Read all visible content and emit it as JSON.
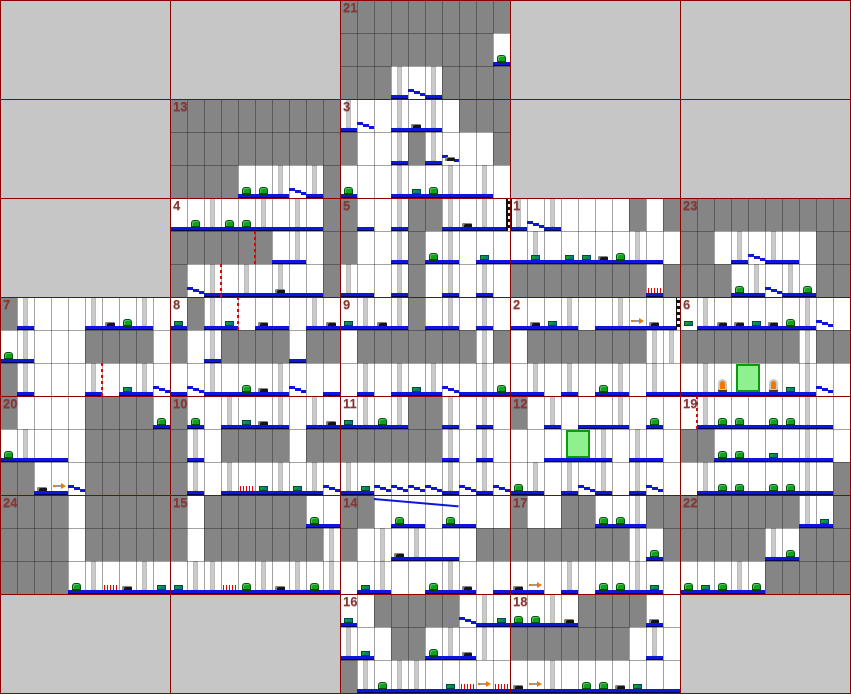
{
  "map": {
    "cols": 5,
    "rows": 7,
    "room_w": 170,
    "room_h": 99,
    "tile": {
      "w": 17,
      "h": 33
    },
    "colors": {
      "unused_cell": "#c6c6c6",
      "room_bg": "#ffffff",
      "block": "#858585",
      "grid_line": "#8b0000",
      "tile_line": "#6f6f6f",
      "pillar": "#cacaca",
      "floor_blue": "#0e16dc",
      "bug_green": "#0da51c",
      "teal_item": "#0a7d7d",
      "black_item": "#151515",
      "spike_red": "#e80000",
      "rope_red": "#e80000",
      "door_fill": "#8ef08e",
      "door_border": "#0a9a0a",
      "figure_orange": "#f07800",
      "arrow_orange": "#f07800",
      "number_text": "#8b3434"
    },
    "legend": {
      "#": "solid-block",
      ".": "empty",
      "_": "floor",
      "l": "pillar",
      "L": "pillar-with-floor",
      "/": "stepped-slope-floor"
    },
    "item_legend": {
      "g": "green-bug",
      "t": "teal-chest",
      "b": "black-debris",
      "k": "red-spikes",
      "a": "right-arrow",
      "r": "red-dashed-rope",
      "S": "striped-pole",
      "d": "green-door",
      "f": "orange-idol",
      "W": "long-ramp"
    },
    "empty_cells": [
      [
        0,
        0
      ],
      [
        1,
        0
      ],
      [
        3,
        0
      ],
      [
        4,
        0
      ],
      [
        0,
        1
      ],
      [
        3,
        1
      ],
      [
        4,
        1
      ],
      [
        0,
        2
      ],
      [
        0,
        6
      ],
      [
        1,
        6
      ],
      [
        4,
        6
      ]
    ],
    "rooms": [
      {
        "n": "21",
        "c": 2,
        "r": 0,
        "t": [
          "##########",
          "#########_",
          "###L/L####"
        ],
        "i": [
          [
            "g",
            9,
            1
          ]
        ]
      },
      {
        "n": "13",
        "c": 1,
        "r": 1,
        "t": [
          "##########",
          "##########",
          "####__L/L#"
        ],
        "i": [
          [
            "g",
            4,
            2
          ],
          [
            "g",
            5,
            2
          ]
        ]
      },
      {
        "n": "3",
        "c": 2,
        "r": 1,
        "t": [
          "L/.L_L.###",
          "#..L#L/..#",
          "_..L__L_L."
        ],
        "i": [
          [
            "b",
            4,
            0
          ],
          [
            "b",
            6,
            1
          ],
          [
            "g",
            0,
            2
          ],
          [
            "t",
            4,
            2
          ],
          [
            "g",
            5,
            2
          ]
        ]
      },
      {
        "n": "4",
        "c": 1,
        "r": 2,
        "t": [
          "__L__L_L_#",
          "######_L.#",
          "#/L_L_L__#"
        ],
        "i": [
          [
            "g",
            1,
            0
          ],
          [
            "g",
            3,
            0
          ],
          [
            "g",
            4,
            0
          ],
          [
            "r",
            5,
            1
          ],
          [
            "r",
            3,
            2
          ],
          [
            "b",
            6,
            2
          ]
        ]
      },
      {
        "n": "5",
        "c": 2,
        "r": 2,
        "t": [
          "#_.L##L_L_",
          "#..L#_L.__",
          "L_.L#.L.L."
        ],
        "i": [
          [
            "S",
            9,
            0,
            13
          ],
          [
            "b",
            7,
            0
          ],
          [
            "g",
            5,
            1
          ],
          [
            "t",
            8,
            1
          ]
        ]
      },
      {
        "n": "1",
        "c": 3,
        "r": 2,
        "t": [
          "L/L....#.#",
          "_L_____L_.",
          "########_#"
        ],
        "i": [
          [
            "S",
            0,
            0,
            -3
          ],
          [
            "t",
            1,
            1
          ],
          [
            "t",
            3,
            1
          ],
          [
            "t",
            4,
            1
          ],
          [
            "b",
            5,
            1
          ],
          [
            "g",
            6,
            1
          ],
          [
            "k",
            8,
            2
          ]
        ]
      },
      {
        "n": "23",
        "c": 4,
        "r": 2,
        "t": [
          "##########",
          "##.L/L_.##",
          "###_L/L_##"
        ],
        "i": [
          [
            "g",
            3,
            2
          ],
          [
            "g",
            7,
            2
          ]
        ]
      },
      {
        "n": "7",
        "c": 0,
        "r": 3,
        "t": [
          "#L...L__L.",
          "_L...####.",
          "#L...L._L/"
        ],
        "i": [
          [
            "b",
            6,
            0
          ],
          [
            "g",
            7,
            0
          ],
          [
            "g",
            0,
            1
          ],
          [
            "r",
            6,
            2
          ],
          [
            "t",
            7,
            2
          ]
        ]
      },
      {
        "n": "8",
        "c": 1,
        "r": 3,
        "t": [
          "_#L_.__.L_",
          "#.L####_##",
          "_/L___L/._"
        ],
        "i": [
          [
            "t",
            0,
            0
          ],
          [
            "t",
            3,
            0
          ],
          [
            "r",
            4,
            0
          ],
          [
            "b",
            5,
            0
          ],
          [
            "b",
            9,
            0
          ],
          [
            "g",
            4,
            2
          ],
          [
            "b",
            5,
            2
          ]
        ]
      },
      {
        "n": "9",
        "c": 2,
        "r": 3,
        "t": [
          "_L_L#_L.L.",
          ".#######l#",
          ".L.L_L/_L_"
        ],
        "i": [
          [
            "t",
            0,
            0
          ],
          [
            "b",
            2,
            0
          ],
          [
            "t",
            4,
            2
          ],
          [
            "g",
            9,
            2
          ]
        ]
      },
      {
        "n": "2",
        "c": 3,
        "r": 3,
        "t": [
          "___L._L___",
          ".#######ll",
          "_L.L._L.L_"
        ],
        "i": [
          [
            "b",
            1,
            0
          ],
          [
            "t",
            2,
            0
          ],
          [
            "a",
            7,
            0
          ],
          [
            "b",
            8,
            0
          ],
          [
            "S",
            9,
            0,
            13
          ],
          [
            "g",
            5,
            2
          ]
        ]
      },
      {
        "n": "6",
        "c": 4,
        "r": 3,
        "t": [
          ".L_____L/.",
          "#######l##",
          "_L_____L/."
        ],
        "i": [
          [
            "t",
            0,
            0
          ],
          [
            "b",
            2,
            0
          ],
          [
            "b",
            3,
            0
          ],
          [
            "t",
            4,
            0
          ],
          [
            "b",
            5,
            0
          ],
          [
            "g",
            6,
            0
          ],
          [
            "f",
            2,
            2
          ],
          [
            "d",
            3,
            2
          ],
          [
            "f",
            5,
            2
          ],
          [
            "t",
            6,
            2
          ]
        ]
      },
      {
        "n": "20",
        "c": 0,
        "r": 4,
        "t": [
          "#....####_",
          "_L__.#####",
          "##__/#####"
        ],
        "i": [
          [
            "g",
            9,
            0
          ],
          [
            "g",
            0,
            1
          ],
          [
            "b",
            2,
            2
          ],
          [
            "a",
            3,
            2
          ]
        ]
      },
      {
        "n": "10",
        "c": 1,
        "r": 4,
        "t": [
          "#_.L__L.L_",
          "#L.####.##",
          "#L.L__L_L/"
        ],
        "i": [
          [
            "g",
            1,
            0
          ],
          [
            "t",
            4,
            0
          ],
          [
            "b",
            5,
            0
          ],
          [
            "b",
            9,
            0
          ],
          [
            "k",
            4,
            2
          ],
          [
            "t",
            5,
            2
          ],
          [
            "t",
            7,
            2
          ]
        ]
      },
      {
        "n": "11",
        "c": 2,
        "r": 4,
        "t": [
          "_L_L##L.L.",
          "######L.L.",
          "L_////L/L/"
        ],
        "i": [
          [
            "t",
            0,
            0
          ],
          [
            "g",
            2,
            0
          ],
          [
            "t",
            1,
            2
          ]
        ]
      },
      {
        "n": "12",
        "c": 3,
        "r": 4,
        "t": [
          "#.L.__L._.",
          "..___L.L_.",
          "_L.L/L.L/."
        ],
        "i": [
          [
            "g",
            8,
            0
          ],
          [
            "d",
            3,
            1
          ],
          [
            "g",
            0,
            2
          ]
        ]
      },
      {
        "n": "19",
        "c": 4,
        "r": 4,
        "t": [
          ".L_____L_.",
          "##_____L_.",
          ".L_____L_#"
        ],
        "i": [
          [
            "r",
            1,
            0
          ],
          [
            "g",
            2,
            0
          ],
          [
            "g",
            3,
            0
          ],
          [
            "g",
            5,
            0
          ],
          [
            "g",
            6,
            0
          ],
          [
            "g",
            2,
            1
          ],
          [
            "g",
            3,
            1
          ],
          [
            "t",
            5,
            1
          ],
          [
            "g",
            2,
            2
          ],
          [
            "g",
            3,
            2
          ],
          [
            "g",
            5,
            2
          ],
          [
            "g",
            6,
            2
          ]
        ]
      },
      {
        "n": "24",
        "c": 0,
        "r": 5,
        "t": [
          "####.#####",
          "####.#####",
          "####_L__L_"
        ],
        "i": [
          [
            "g",
            4,
            2
          ],
          [
            "k",
            6,
            2
          ],
          [
            "b",
            7,
            2
          ],
          [
            "t",
            9,
            2
          ]
        ]
      },
      {
        "n": "15",
        "c": 1,
        "r": 5,
        "t": [
          "#.######__",
          "#.#######l",
          "_LL__L_L_L"
        ],
        "i": [
          [
            "g",
            8,
            0
          ],
          [
            "t",
            0,
            2
          ],
          [
            "k",
            3,
            2
          ],
          [
            "g",
            4,
            2
          ],
          [
            "b",
            6,
            2
          ],
          [
            "g",
            8,
            2
          ]
        ]
      },
      {
        "n": "14",
        "c": 2,
        "r": 5,
        "t": [
          "##.__.__..",
          "#.l_L__.##",
          "._L.._L_._"
        ],
        "i": [
          [
            "W",
            2,
            0,
            5
          ],
          [
            "g",
            3,
            0
          ],
          [
            "g",
            6,
            0
          ],
          [
            "b",
            3,
            1
          ],
          [
            "t",
            1,
            2
          ],
          [
            "g",
            5,
            2
          ],
          [
            "b",
            7,
            2
          ]
        ]
      },
      {
        "n": "17",
        "c": 3,
        "r": 5,
        "t": [
          "#..##__L##",
          "#######l_#",
          "__.L.__L_."
        ],
        "i": [
          [
            "g",
            5,
            0
          ],
          [
            "g",
            6,
            0
          ],
          [
            "g",
            8,
            1
          ],
          [
            "b",
            0,
            2
          ],
          [
            "a",
            1,
            2
          ],
          [
            "g",
            5,
            2
          ],
          [
            "g",
            6,
            2
          ],
          [
            "t",
            8,
            2
          ]
        ]
      },
      {
        "n": "22",
        "c": 4,
        "r": 5,
        "t": [
          "#######L_#",
          "#####L_###",
          "___L_#####"
        ],
        "i": [
          [
            "t",
            8,
            0
          ],
          [
            "g",
            6,
            1
          ],
          [
            "g",
            0,
            2
          ],
          [
            "t",
            1,
            2
          ],
          [
            "g",
            2,
            2
          ],
          [
            "g",
            4,
            2
          ]
        ]
      },
      {
        "n": "16",
        "c": 2,
        "r": 6,
        "t": [
          "_.#####/L_",
          "L_.##_L_l.",
          "#L_LL_____"
        ],
        "i": [
          [
            "t",
            0,
            0
          ],
          [
            "t",
            9,
            0
          ],
          [
            "t",
            1,
            1
          ],
          [
            "g",
            5,
            1
          ],
          [
            "b",
            7,
            1
          ],
          [
            "g",
            2,
            2
          ],
          [
            "t",
            6,
            2
          ],
          [
            "k",
            7,
            2
          ],
          [
            "a",
            8,
            2
          ],
          [
            "k",
            9,
            2
          ]
        ]
      },
      {
        "n": "18",
        "c": 3,
        "r": 6,
        "t": [
          "__L_####_.",
          "#######.L.",
          "__L_______"
        ],
        "i": [
          [
            "g",
            0,
            0
          ],
          [
            "g",
            1,
            0
          ],
          [
            "b",
            3,
            0
          ],
          [
            "b",
            8,
            0
          ],
          [
            "b",
            0,
            2
          ],
          [
            "a",
            1,
            2
          ],
          [
            "g",
            4,
            2
          ],
          [
            "g",
            5,
            2
          ],
          [
            "b",
            6,
            2
          ],
          [
            "t",
            7,
            2
          ]
        ]
      }
    ]
  }
}
